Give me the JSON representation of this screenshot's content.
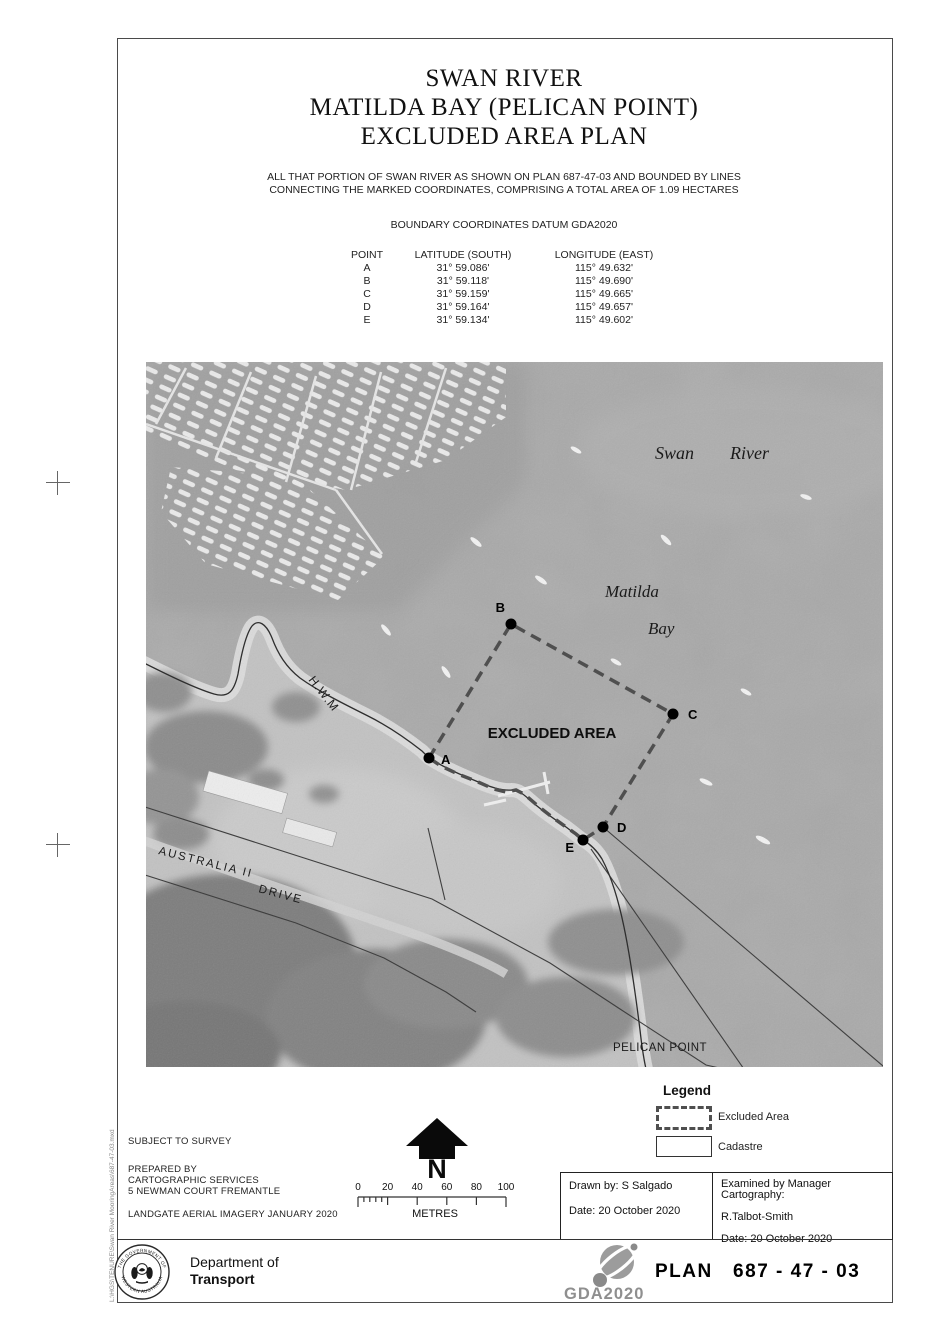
{
  "doc": {
    "title_lines": [
      "SWAN RIVER",
      "MATILDA BAY (PELICAN POINT)",
      "EXCLUDED AREA PLAN"
    ],
    "description_lines": [
      "ALL THAT PORTION OF SWAN RIVER AS SHOWN ON PLAN 687-47-03 AND BOUNDED BY LINES",
      "CONNECTING THE MARKED COORDINATES, COMPRISING A TOTAL AREA OF 1.09 HECTARES"
    ],
    "datum_line": "BOUNDARY COORDINATES DATUM GDA2020"
  },
  "coords": {
    "headers": {
      "point": "POINT",
      "lat": "LATITUDE (SOUTH)",
      "lon": "LONGITUDE (EAST)"
    },
    "rows": [
      {
        "point": "A",
        "lat": "31° 59.086'",
        "lon": "115° 49.632'"
      },
      {
        "point": "B",
        "lat": "31° 59.118'",
        "lon": "115° 49.690'"
      },
      {
        "point": "C",
        "lat": "31° 59.159'",
        "lon": "115° 49.665'"
      },
      {
        "point": "D",
        "lat": "31° 59.164'",
        "lon": "115° 49.657'"
      },
      {
        "point": "E",
        "lat": "31° 59.134'",
        "lon": "115° 49.602'"
      }
    ]
  },
  "map": {
    "labels": {
      "swan": "Swan",
      "river": "River",
      "matilda": "Matilda",
      "bay": "Bay",
      "hwm": "H.W.M",
      "excluded_area": "EXCLUDED AREA",
      "australia_ii": "AUSTRALIA II",
      "drive": "DRIVE",
      "pelican_point": "PELICAN POINT"
    },
    "point_labels": [
      "A",
      "B",
      "C",
      "D",
      "E"
    ]
  },
  "legend": {
    "title": "Legend",
    "items": [
      "Excluded Area",
      "Cadastre"
    ]
  },
  "notes": {
    "l1": "SUBJECT TO SURVEY",
    "l2": "PREPARED BY",
    "l3": "CARTOGRAPHIC SERVICES",
    "l4": "5 NEWMAN COURT FREMANTLE",
    "l5": "LANDGATE AERIAL IMAGERY JANUARY 2020"
  },
  "north_label": "N",
  "scale_bar": {
    "ticks": [
      "0",
      "20",
      "40",
      "60",
      "80",
      "100"
    ],
    "unit": "METRES"
  },
  "title_block": {
    "drawn_by": "Drawn by: S Salgado",
    "drawn_date": "Date: 20 October 2020",
    "examined_by": "Examined by Manager Cartography:",
    "examiner": "R.Talbot-Smith",
    "examined_date": "Date: 20 October 2020"
  },
  "footer": {
    "crest_top": "THE GOVERNMENT OF",
    "crest_bottom": "WESTERN AUSTRALIA",
    "dept_line1": "Department of",
    "dept_line2": "Transport",
    "gda_logo": "GDA2020",
    "plan_number": "PLAN   687 - 47 - 03",
    "file_path": "L:\\HGS\\TENURE\\Swan River MooringAreas\\687-47-03.mxd"
  },
  "colors": {
    "water": "#a9a9a9",
    "land": "#c2c2c2",
    "beach": "#dedede",
    "trees": "#828282",
    "boundary_dash": "#4f4f4f",
    "cadastre_line": "#3f3f3f",
    "logo_gray": "#8f8f8f",
    "ink": "#111111"
  }
}
